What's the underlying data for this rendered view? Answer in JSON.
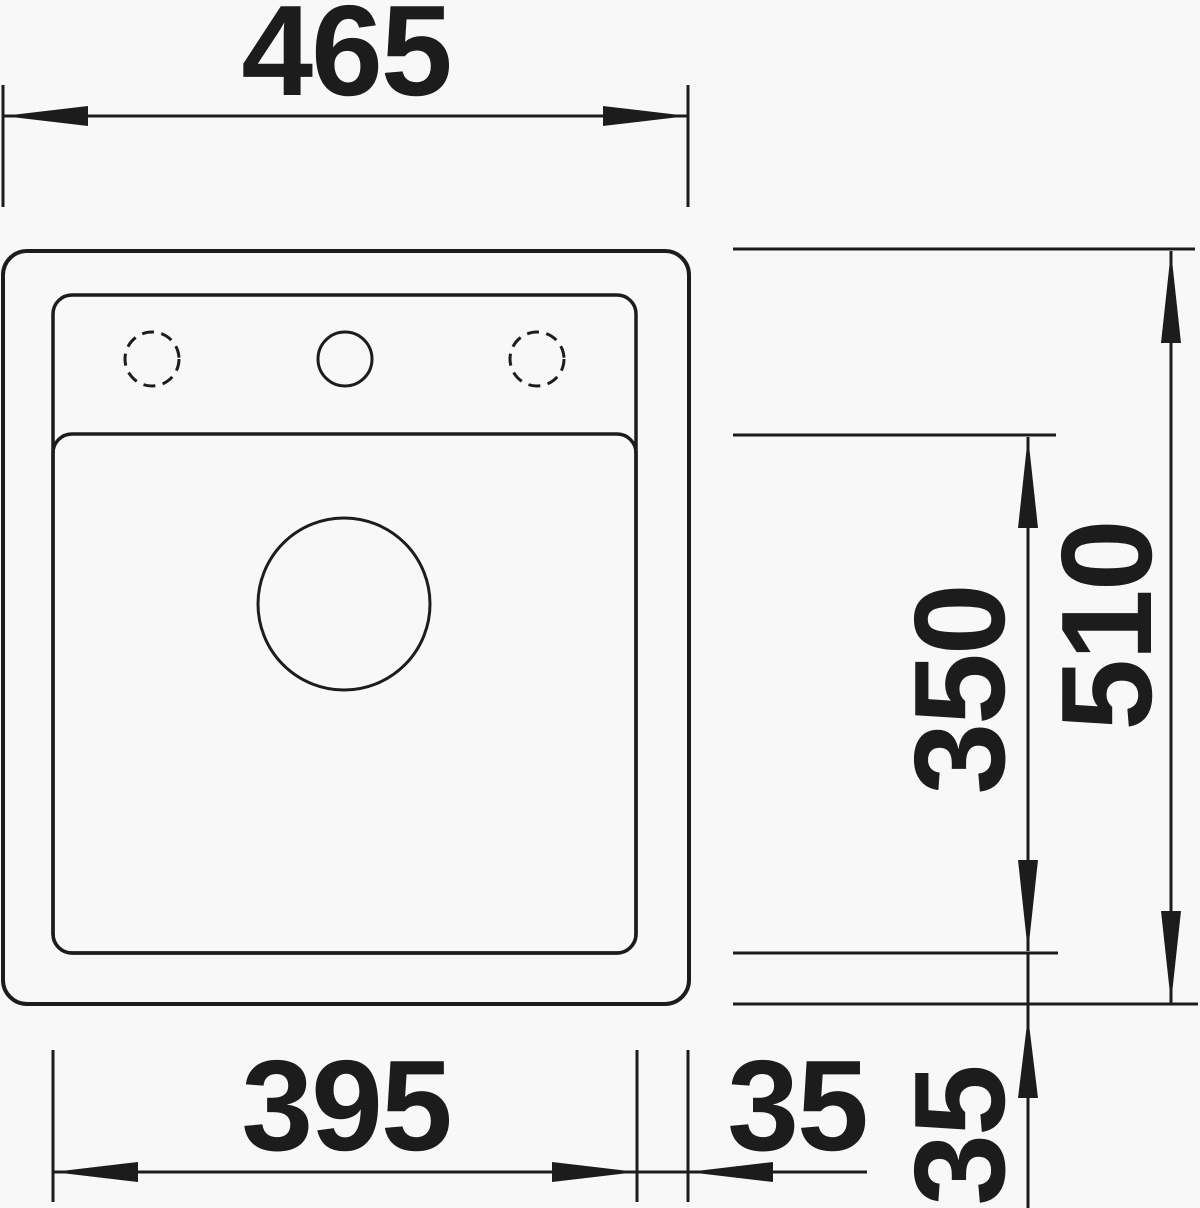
{
  "drawing": {
    "kind": "sink-top-view-technical-drawing",
    "colors": {
      "line": "#1c1c1c",
      "background": "#f8f8f8"
    },
    "dimensions": {
      "overall_width": {
        "value": "465",
        "position": "top",
        "orientation": "horizontal"
      },
      "overall_depth": {
        "value": "510",
        "position": "right",
        "orientation": "vertical"
      },
      "bowl_depth": {
        "value": "350",
        "position": "right",
        "orientation": "vertical"
      },
      "bowl_width": {
        "value": "395",
        "position": "bottom",
        "orientation": "horizontal"
      },
      "rim_offset_right": {
        "value": "35",
        "position": "bottom",
        "orientation": "horizontal"
      },
      "rim_offset_bottom": {
        "value": "35",
        "position": "bottom-right",
        "orientation": "vertical"
      }
    }
  }
}
